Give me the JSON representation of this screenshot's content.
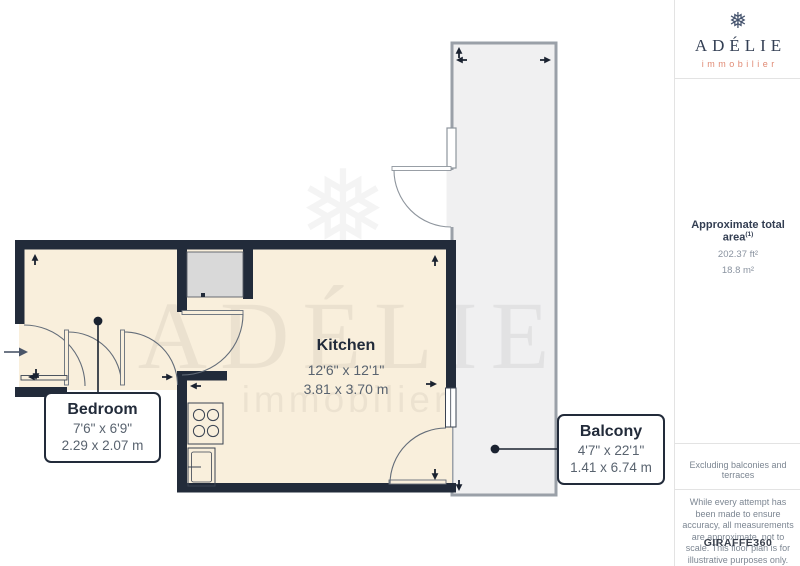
{
  "brand": {
    "snowflake": "❅",
    "name": "ADÉLIE",
    "tagline": "immobilier"
  },
  "sidebar": {
    "area": {
      "title": "Approximate total area",
      "superscript": "(1)",
      "imperial": "202.37 ft²",
      "metric": "18.8 m²"
    },
    "exclusion_note": "Excluding balconies and terraces",
    "disclaimer": "While every attempt has been made to ensure accuracy, all measurements are approximate, not to scale. This floor plan is for illustrative purposes only.",
    "credit_brand": "GIRAFFE",
    "credit_suffix": "360"
  },
  "floorplan": {
    "watermark": {
      "snowflake": "❅",
      "name": "ADÉLIE",
      "tagline": "immobilier"
    },
    "rooms": [
      {
        "name": "Bedroom",
        "imperial": "7'6\" x 6'9\"",
        "metric": "2.29 x 2.07 m"
      },
      {
        "name": "Kitchen",
        "imperial": "12'6\" x 12'1\"",
        "metric": "3.81 x 3.70 m"
      },
      {
        "name": "Balcony",
        "imperial": "4'7\" x 22'1\"",
        "metric": "1.41 x 6.74 m"
      }
    ],
    "colors": {
      "wall": "#222B3A",
      "floor": "#F9EFDC",
      "balcony_floor": "#F0F0F1",
      "thin_wall": "#9AA0A8",
      "door_arc": "#646D79"
    }
  }
}
